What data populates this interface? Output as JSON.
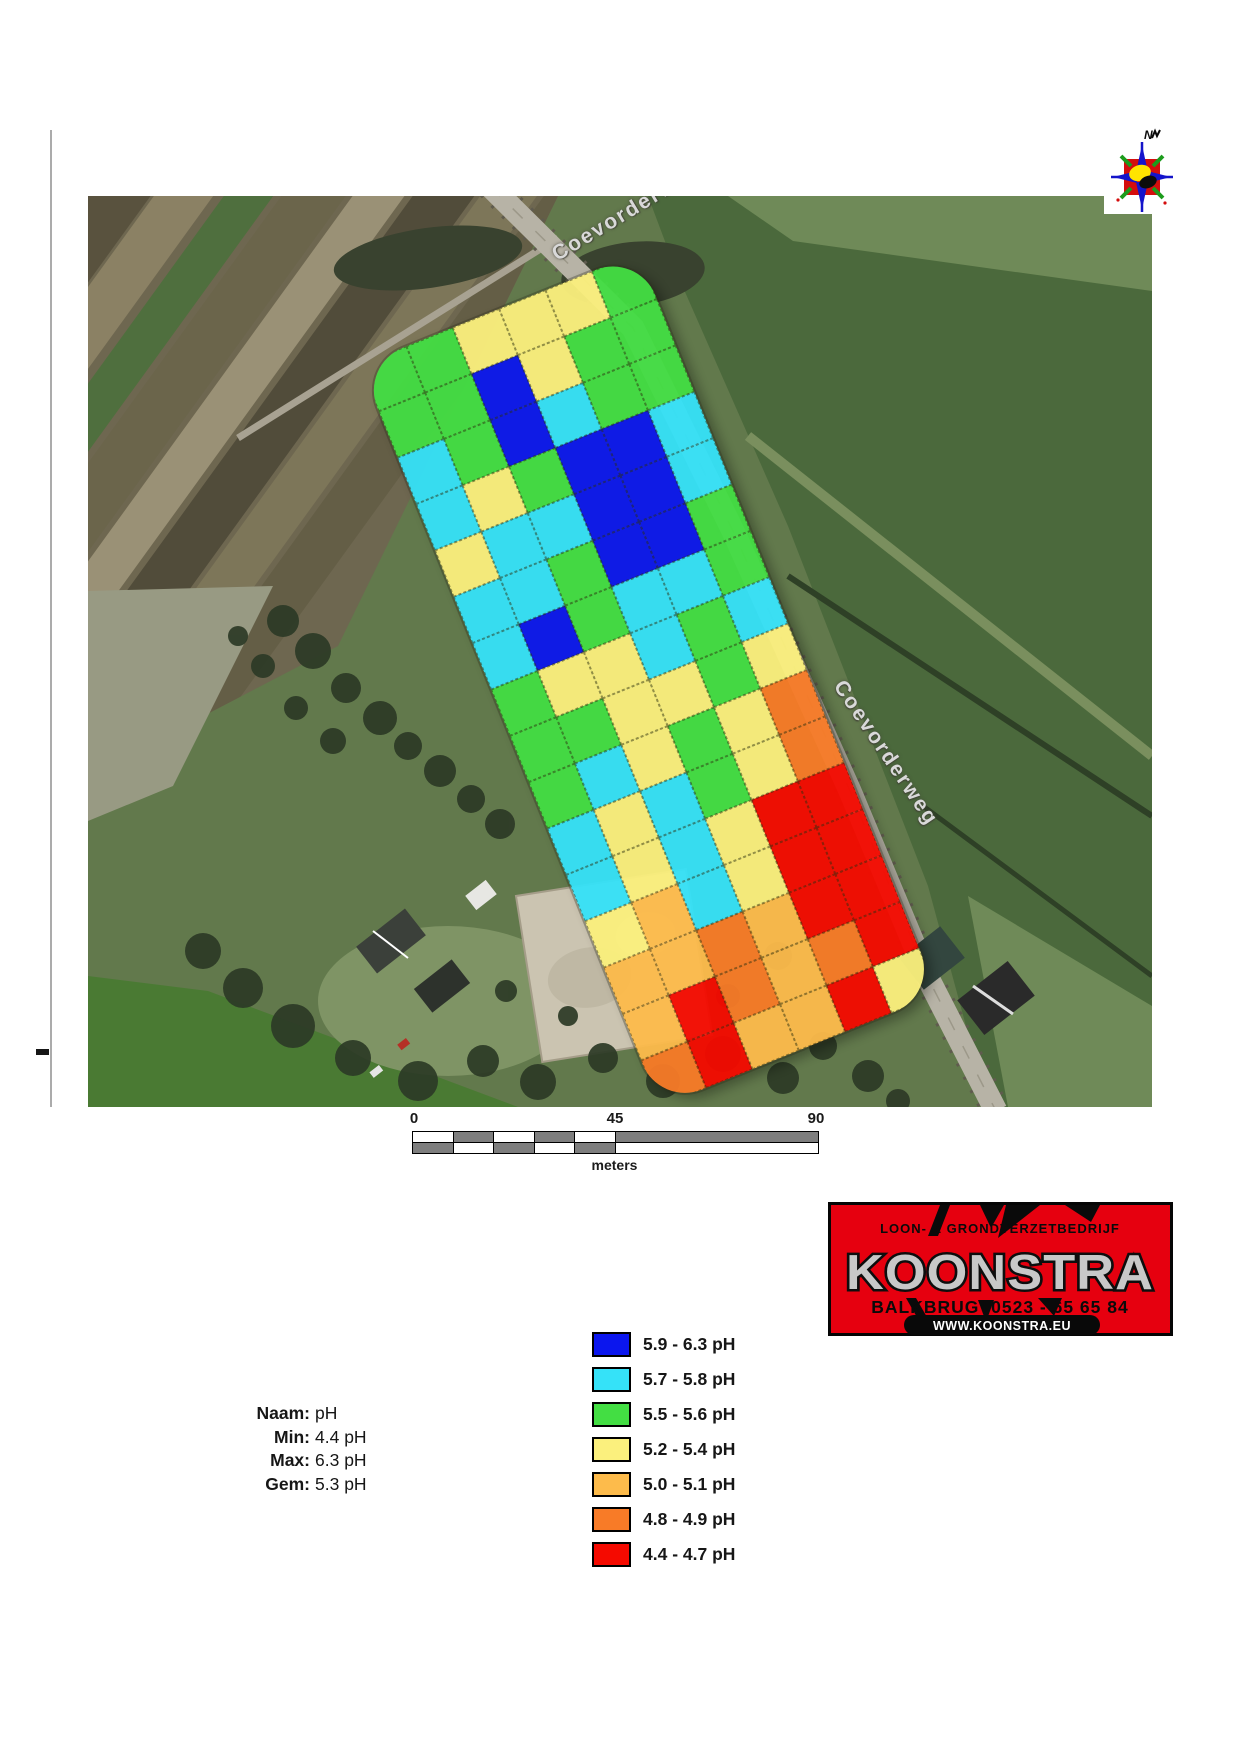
{
  "compass": {
    "north_label": "N"
  },
  "map": {
    "road_label_upper": "Coevorderweg",
    "road_label_lower": "Coevorderweg",
    "grid": {
      "palette": {
        "B": "#0b16ee",
        "C": "#35e2f8",
        "G": "#43de43",
        "Y": "#fbf07d",
        "O": "#fdbb4b",
        "D": "#f87b27",
        "R": "#f50a00"
      },
      "rows": [
        [
          "G",
          "G",
          "Y",
          "Y",
          "Y",
          "G"
        ],
        [
          "G",
          "G",
          "B",
          "Y",
          "G",
          "G"
        ],
        [
          "C",
          "G",
          "B",
          "C",
          "G",
          "G"
        ],
        [
          "C",
          "Y",
          "G",
          "B",
          "B",
          "C"
        ],
        [
          "Y",
          "C",
          "C",
          "B",
          "B",
          "C"
        ],
        [
          "C",
          "C",
          "G",
          "B",
          "B",
          "G"
        ],
        [
          "C",
          "B",
          "G",
          "C",
          "C",
          "G"
        ],
        [
          "G",
          "Y",
          "Y",
          "C",
          "G",
          "C"
        ],
        [
          "G",
          "G",
          "Y",
          "Y",
          "G",
          "Y"
        ],
        [
          "G",
          "C",
          "Y",
          "G",
          "Y",
          "D"
        ],
        [
          "C",
          "Y",
          "C",
          "G",
          "Y",
          "D"
        ],
        [
          "C",
          "Y",
          "C",
          "Y",
          "R",
          "R"
        ],
        [
          "Y",
          "O",
          "C",
          "Y",
          "R",
          "R"
        ],
        [
          "O",
          "O",
          "D",
          "O",
          "R",
          "R"
        ],
        [
          "O",
          "R",
          "D",
          "O",
          "D",
          "R"
        ],
        [
          "D",
          "R",
          "O",
          "O",
          "R",
          "Y"
        ]
      ]
    }
  },
  "scalebar": {
    "ticks": [
      "0",
      "45",
      "90"
    ],
    "unit_label": "meters",
    "rows": [
      [
        {
          "w": 40.5,
          "c": "#ffffff"
        },
        {
          "w": 40.5,
          "c": "#7e7e7e"
        },
        {
          "w": 40.5,
          "c": "#ffffff"
        },
        {
          "w": 40.5,
          "c": "#7e7e7e"
        },
        {
          "w": 40.5,
          "c": "#ffffff"
        },
        {
          "w": 202.5,
          "c": "#7e7e7e"
        }
      ],
      [
        {
          "w": 40.5,
          "c": "#7e7e7e"
        },
        {
          "w": 40.5,
          "c": "#ffffff"
        },
        {
          "w": 40.5,
          "c": "#7e7e7e"
        },
        {
          "w": 40.5,
          "c": "#ffffff"
        },
        {
          "w": 40.5,
          "c": "#7e7e7e"
        },
        {
          "w": 202.5,
          "c": "#ffffff"
        }
      ]
    ]
  },
  "stats": {
    "rows": [
      {
        "label": "Naam:",
        "value": "pH"
      },
      {
        "label": "Min:",
        "value": "4.4 pH"
      },
      {
        "label": "Max:",
        "value": "6.3 pH"
      },
      {
        "label": "Gem:",
        "value": "5.3 pH"
      }
    ]
  },
  "legend": {
    "items": [
      {
        "color": "#0b16ee",
        "label": "5.9 - 6.3 pH"
      },
      {
        "color": "#35e2f8",
        "label": "5.7 - 5.8 pH"
      },
      {
        "color": "#43de43",
        "label": "5.5 - 5.6 pH"
      },
      {
        "color": "#fbf07d",
        "label": "5.2 - 5.4 pH"
      },
      {
        "color": "#fdbb4b",
        "label": "5.0 - 5.1 pH"
      },
      {
        "color": "#f87b27",
        "label": "4.8 - 4.9 pH"
      },
      {
        "color": "#f50a00",
        "label": "4.4 - 4.7 pH"
      }
    ]
  },
  "logo": {
    "tagline": "LOON- & GRONDVERZETBEDRIJF",
    "name": "KOONSTRA",
    "phone_line": "BALKBRUG  0523 - 65 65 84",
    "website": "WWW.KOONSTRA.EU",
    "brand_red": "#e6000f"
  }
}
